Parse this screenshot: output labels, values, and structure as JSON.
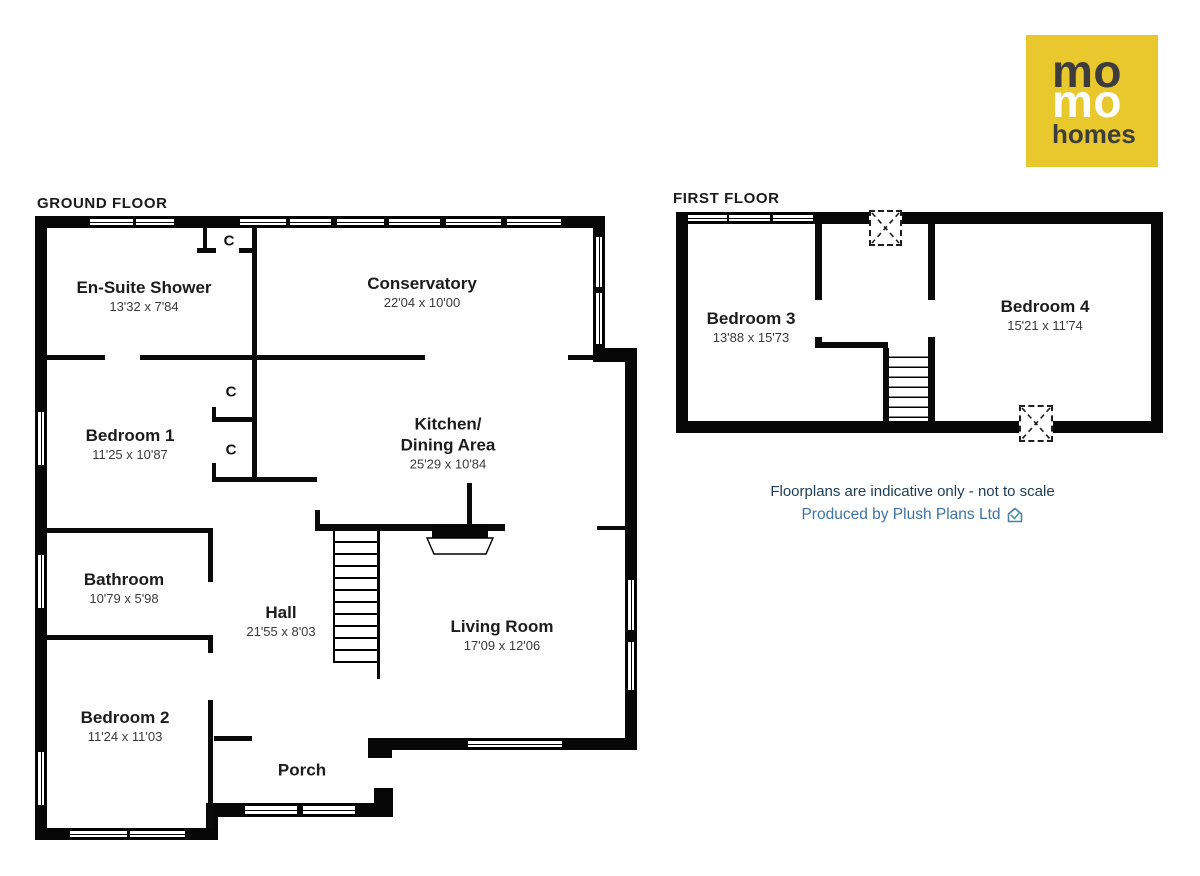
{
  "logo": {
    "line1": "mo",
    "line2": "mo",
    "line3": "homes",
    "bg_color": "#e9c82d",
    "dark_color": "#3d3d3e",
    "light_color": "#ffffff"
  },
  "floors": {
    "ground": {
      "heading": "GROUND FLOOR",
      "rooms": [
        {
          "name": "En-Suite Shower",
          "dims": "13'32 x 7'84"
        },
        {
          "name": "Conservatory",
          "dims": "22'04 x 10'00"
        },
        {
          "name": "Bedroom 1",
          "dims": "11'25 x 10'87"
        },
        {
          "name_line1": "Kitchen/",
          "name_line2": "Dining Area",
          "dims": "25'29 x 10'84"
        },
        {
          "name": "Bathroom",
          "dims": "10'79 x 5'98"
        },
        {
          "name": "Hall",
          "dims": "21'55 x 8'03"
        },
        {
          "name": "Living Room",
          "dims": "17'09 x 12'06"
        },
        {
          "name": "Bedroom 2",
          "dims": "11'24 x 11'03"
        },
        {
          "name": "Porch"
        }
      ],
      "closet_labels": [
        "C",
        "C",
        "C"
      ]
    },
    "first": {
      "heading": "FIRST FLOOR",
      "rooms": [
        {
          "name": "Bedroom 3",
          "dims": "13'88 x 15'73"
        },
        {
          "name": "Bedroom 4",
          "dims": "15'21 x 11'74"
        }
      ]
    }
  },
  "footer": {
    "disclaimer": "Floorplans are indicative only - not to scale",
    "credit": "Produced by Plush Plans Ltd",
    "disclaimer_color": "#1d3c54",
    "credit_color": "#3d74a6",
    "house_icon": "house-check-icon"
  },
  "colors": {
    "wall": "#070707",
    "background": "#ffffff"
  }
}
